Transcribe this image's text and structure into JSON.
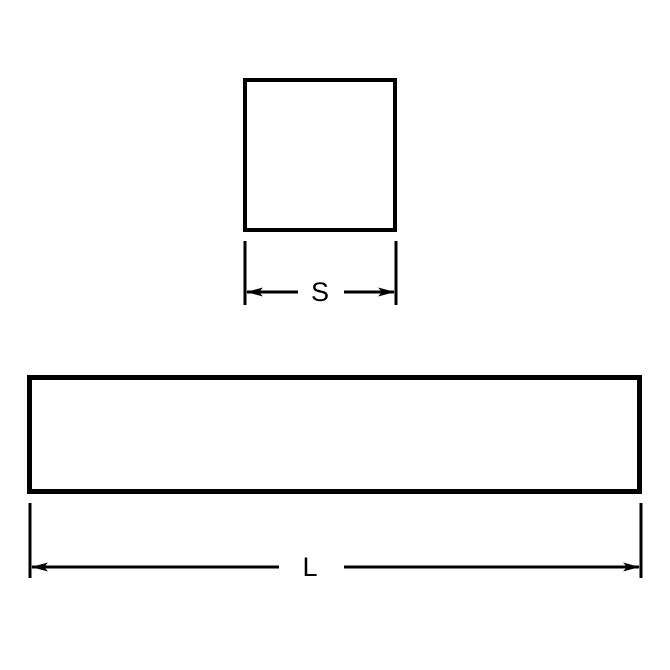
{
  "page": {
    "background_color": "#ffffff",
    "line_color": "#000000"
  },
  "drawing": {
    "description": "dimension-drawing",
    "cross_section_view": {
      "shape": "square",
      "dimension_label": "S"
    },
    "length_view": {
      "shape": "rectangle",
      "dimension_label": "L"
    }
  }
}
